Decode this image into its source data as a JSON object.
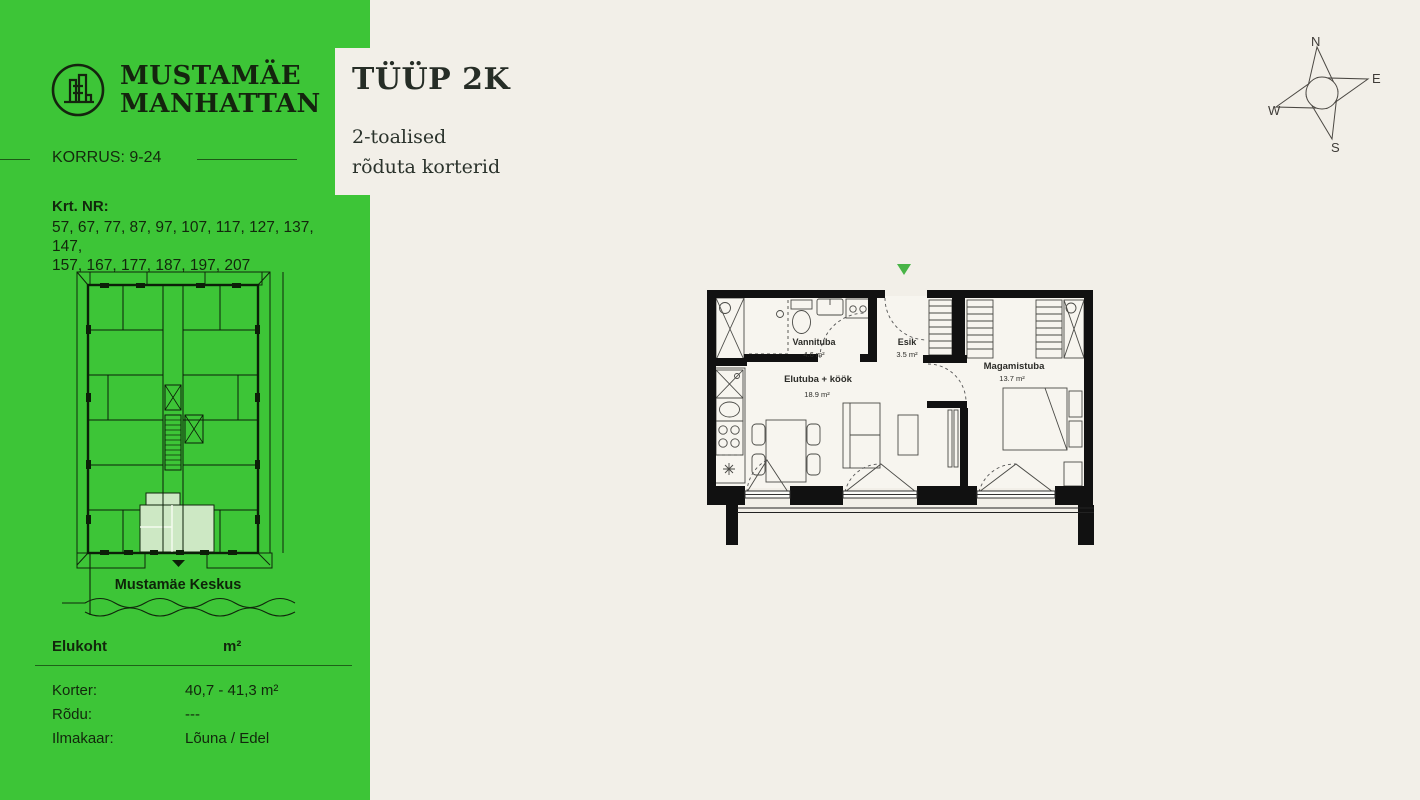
{
  "sidebar": {
    "brand": {
      "line1": "MUSTAMÄE",
      "line2": "MANHATTAN"
    },
    "floor_label": "KORRUS: 9-24",
    "apartments_label": "Krt. NR:",
    "apartments_line1": "57, 67, 77, 87, 97, 107, 117, 127, 137, 147,",
    "apartments_line2": "157, 167, 177, 187, 197, 207",
    "mini_map": {
      "location_label": "Mustamäe Keskus"
    },
    "table": {
      "header": {
        "col1": "Elukoht",
        "col2": "m²"
      },
      "rows": [
        {
          "label": "Korter:",
          "value": "40,7 - 41,3 m²"
        },
        {
          "label": "Rõdu:",
          "value": "---"
        },
        {
          "label": "Ilmakaar:",
          "value": "Lõuna / Edel"
        }
      ]
    }
  },
  "header": {
    "type_title": "TÜÜP 2K",
    "subtitle_line1": "2-toalised",
    "subtitle_line2": "rõduta korterid"
  },
  "floor_plan": {
    "rooms": [
      {
        "name": "Vannituba",
        "area": "4.6 m²"
      },
      {
        "name": "Esik",
        "area": "3.5 m²"
      },
      {
        "name": "Elutuba + köök",
        "area": "18.9 m²"
      },
      {
        "name": "Magamistuba",
        "area": "13.7 m²"
      }
    ]
  },
  "compass": {
    "n": "N",
    "e": "E",
    "s": "S",
    "w": "W"
  },
  "colors": {
    "sidebar_green": "#3dc537",
    "highlight_green": "#cde8c4",
    "entrance_marker": "#48b446",
    "background_cream": "#f2efe8",
    "wall_black": "#111111",
    "line_gray": "#4a4a46"
  }
}
